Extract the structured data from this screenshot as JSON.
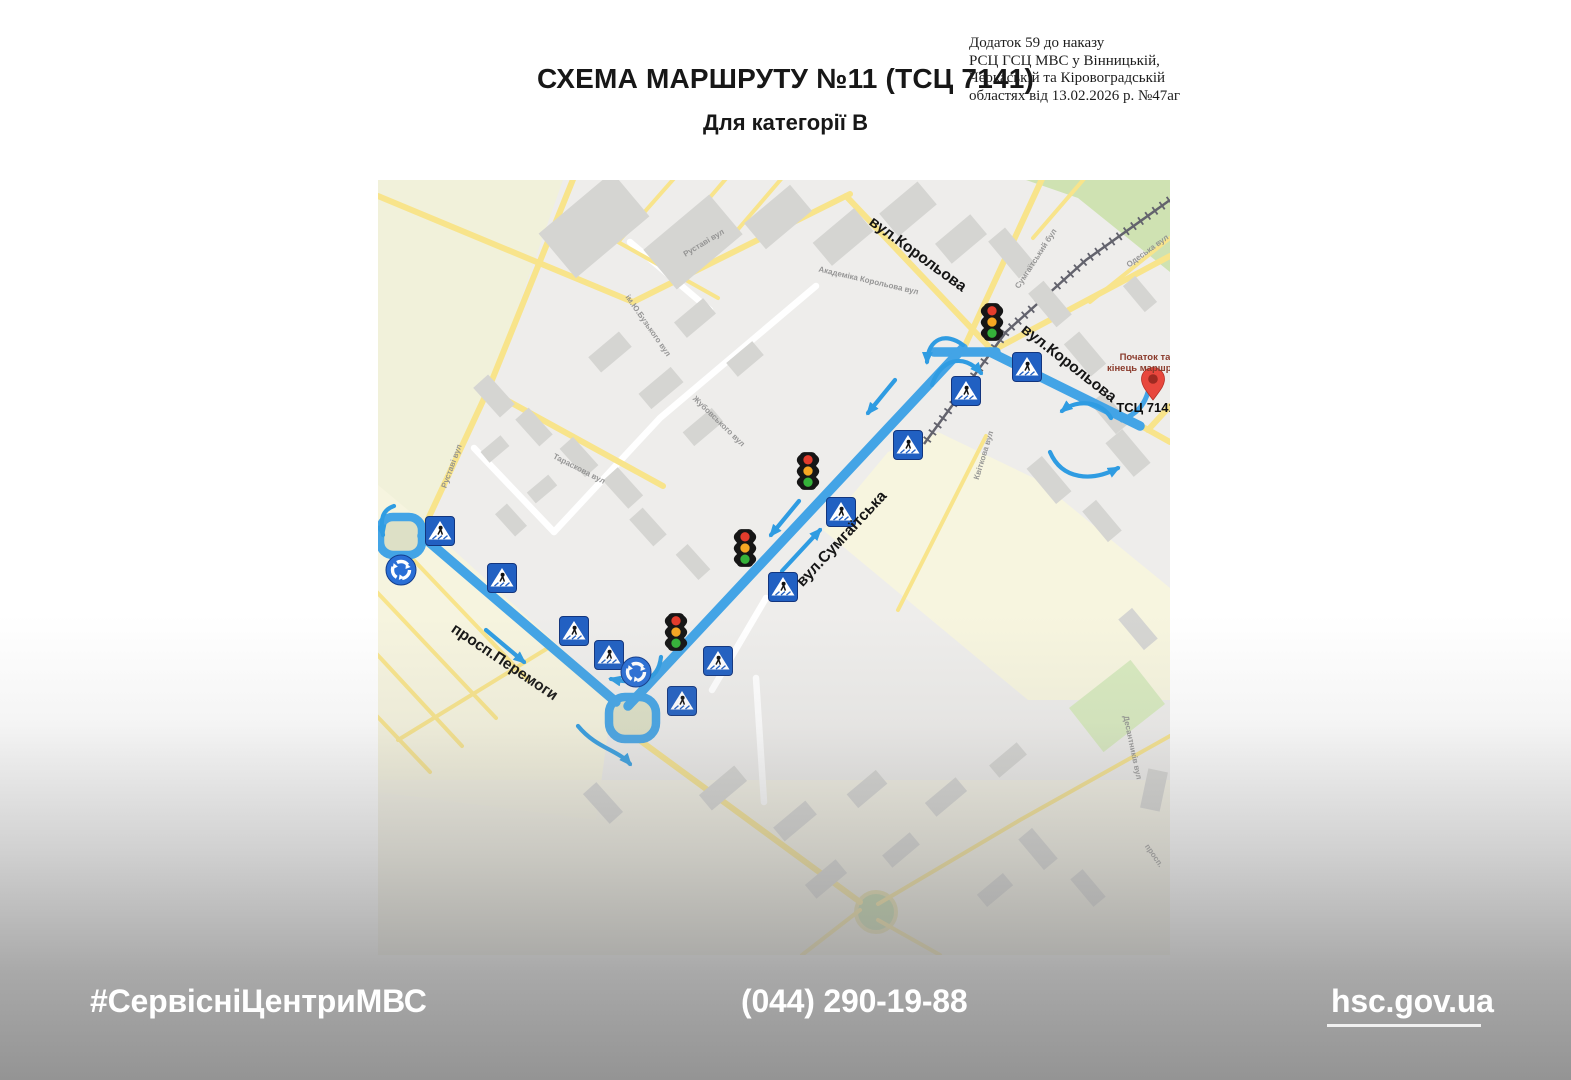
{
  "header": {
    "title": "СХЕМА МАРШРУТУ №11 (ТСЦ 7141)",
    "subtitle": "Для категорії В",
    "order_note": [
      "Додаток 59 до наказу",
      "РСЦ ГСЦ МВС у Вінницькій,",
      "Черкаській та Кіровоградській",
      "областях від 13.02.2026 р. №47аг"
    ]
  },
  "map": {
    "colors": {
      "route_blue": "#43a4e6",
      "arrow_blue": "#2f9ce2",
      "sign_blue": "#2160c2",
      "pin_red": "#e8473d",
      "field_green": "#f1f1da",
      "field_cream": "#f6f4e0"
    },
    "labels": [
      {
        "id": "street-label-korolova-1",
        "text": "вул.Корольова",
        "x": 537,
        "y": 78,
        "rot": 36,
        "cls": "street-major"
      },
      {
        "id": "street-label-korolova-2",
        "text": "вул.Корольова",
        "x": 688,
        "y": 187,
        "rot": 38,
        "cls": "street-major"
      },
      {
        "id": "street-label-sumhaitska",
        "text": "вул.Сумгаїтська",
        "x": 467,
        "y": 362,
        "rot": -47,
        "cls": "street-major"
      },
      {
        "id": "street-label-peremohy",
        "text": "просп.Перемоги",
        "x": 124,
        "y": 486,
        "rot": 34,
        "cls": "street-major"
      },
      {
        "id": "street-label-rustavi-1",
        "text": "Руставі вул",
        "x": 327,
        "y": 65,
        "rot": -31,
        "cls": "street-minor"
      },
      {
        "id": "street-label-sumhaitskyi-bul",
        "text": "Сумгаїтський бул",
        "x": 660,
        "y": 80,
        "rot": -57,
        "cls": "street-minor"
      },
      {
        "id": "street-label-odeska",
        "text": "Одеська вул",
        "x": 771,
        "y": 73,
        "rot": -36,
        "cls": "street-minor"
      },
      {
        "id": "street-label-akademika-korolova",
        "text": "Академіка Корольова вул",
        "x": 490,
        "y": 103,
        "rot": 13,
        "cls": "street-minor"
      },
      {
        "id": "street-label-zhubovskoho",
        "text": "Жубовського вул",
        "x": 339,
        "y": 243,
        "rot": 44,
        "cls": "street-minor"
      },
      {
        "id": "street-label-rustavi-2",
        "text": "Руставі вул",
        "x": 76,
        "y": 287,
        "rot": -70,
        "cls": "street-minor"
      },
      {
        "id": "street-label-taraskova",
        "text": "Тараскова вул",
        "x": 200,
        "y": 291,
        "rot": 27,
        "cls": "street-minor"
      },
      {
        "id": "street-label-kvitkova",
        "text": "Квіткова вул",
        "x": 608,
        "y": 276,
        "rot": -73,
        "cls": "street-minor"
      },
      {
        "id": "street-label-buzkoho",
        "text": "ім.Ю.Бузького вул",
        "x": 268,
        "y": 147,
        "rot": 55,
        "cls": "street-minor"
      },
      {
        "id": "street-label-desantnykiv",
        "text": "Десантників вул",
        "x": 752,
        "y": 568,
        "rot": 78,
        "cls": "street-minor"
      },
      {
        "id": "street-label-prosp",
        "text": "просп.",
        "x": 774,
        "y": 677,
        "rot": 55,
        "cls": "street-minor"
      },
      {
        "id": "route-start-end-label-line1",
        "text": "Початок та",
        "x": 767,
        "y": 180,
        "rot": 0,
        "cls": "start-end"
      },
      {
        "id": "route-start-end-label-line2",
        "text": "кінець маршруту",
        "x": 769,
        "y": 191,
        "rot": 0,
        "cls": "start-end"
      },
      {
        "id": "tsc-7141-label",
        "text": "ТСЦ 7141",
        "x": 768,
        "y": 232,
        "rot": 0,
        "cls": "tsc"
      }
    ],
    "traffic_lights": [
      {
        "x": 614,
        "y": 142
      },
      {
        "x": 430,
        "y": 291
      },
      {
        "x": 367,
        "y": 368
      },
      {
        "x": 298,
        "y": 452
      }
    ],
    "crossings": [
      {
        "x": 649,
        "y": 187
      },
      {
        "x": 588,
        "y": 211
      },
      {
        "x": 530,
        "y": 265
      },
      {
        "x": 463,
        "y": 332
      },
      {
        "x": 405,
        "y": 407
      },
      {
        "x": 340,
        "y": 481
      },
      {
        "x": 231,
        "y": 475
      },
      {
        "x": 196,
        "y": 451
      },
      {
        "x": 124,
        "y": 398
      },
      {
        "x": 62,
        "y": 351
      },
      {
        "x": 304,
        "y": 521
      }
    ],
    "roundabouts": [
      {
        "x": 23,
        "y": 390
      },
      {
        "x": 258,
        "y": 492
      }
    ],
    "pin": {
      "x": 775,
      "y": 220
    }
  },
  "footer": {
    "hashtag": "#СервісніЦентриМВС",
    "phone": "(044) 290-19-88",
    "website": "hsc.gov.ua"
  }
}
